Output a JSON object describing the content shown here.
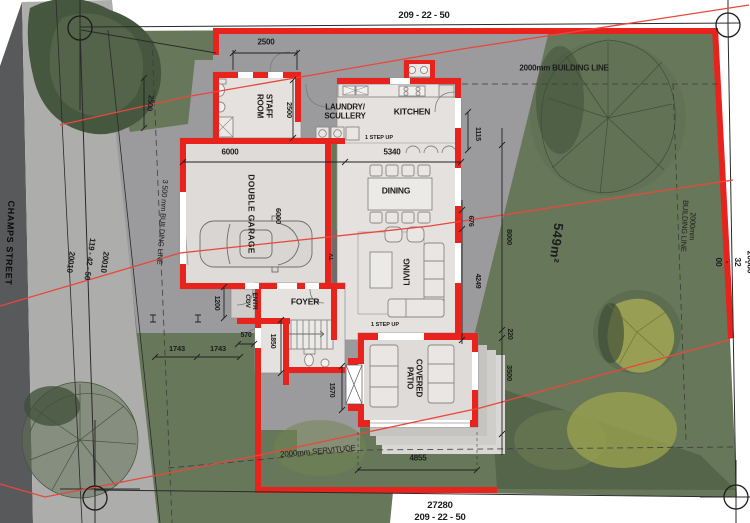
{
  "colors": {
    "wall_red": "#e8231e",
    "service_line_red": "#e8483c",
    "site_green": "#67785a",
    "tree_dark_green": "#3e4e38",
    "tree_yellow_green": "#a2a855",
    "street_gray": "#58595b",
    "verge_gray": "#adadac",
    "paving_gray": "#9b9b9d",
    "room_fill": "#e4e1de"
  },
  "street": {
    "name": "CHAMPS STREET"
  },
  "boundaries": {
    "top_bearing": "209 - 22 - 50",
    "bottom_bearing": "209 - 22 - 50",
    "bottom_distance": "27280",
    "left_bearing": "119 - 42 - 50",
    "left_distance_a": "20010",
    "left_distance_b": "20010",
    "right_bearing": "118 - 32 - 00",
    "right_distance": "20080"
  },
  "site": {
    "area": "549m²",
    "building_line_top": "2000mm BUILDING LINE",
    "building_line_right": "2000mm BUILDING LINE",
    "building_line_left": "3 500 mm BUILDING LINE",
    "servitude": "2000mm SERVITUDE"
  },
  "rooms": {
    "staff": [
      "STAFF",
      "ROOM"
    ],
    "laundry": [
      "LAUNDRY/",
      "SCULLERY"
    ],
    "kitchen": "KITCHEN",
    "garage": "DOUBLE GARAGE",
    "dining": "DINING",
    "living": "LIVING",
    "foyer": "FOYER",
    "entrance": [
      "ENTR",
      "COV"
    ],
    "patio": [
      "COVERED",
      "PATIO"
    ]
  },
  "annotations": {
    "step_up": "1 STEP UP",
    "tv": "TV"
  },
  "dimensions": {
    "top_2500": "2500",
    "staff_2500": "2500",
    "left_2500": "2500",
    "garage_width": "6000",
    "garage_depth": "6000",
    "kitchen_5340": "5340",
    "east_1115": "1115",
    "east_676": "676",
    "east_8000": "8000",
    "east_4249": "4249",
    "east_220": "220",
    "east_3500": "3500",
    "court_570": "570",
    "stair_1850": "1850",
    "court_1200": "1200",
    "court_1743_a": "1743",
    "court_1743_b": "1743",
    "window_1570": "1570",
    "patio_4855": "4855"
  }
}
